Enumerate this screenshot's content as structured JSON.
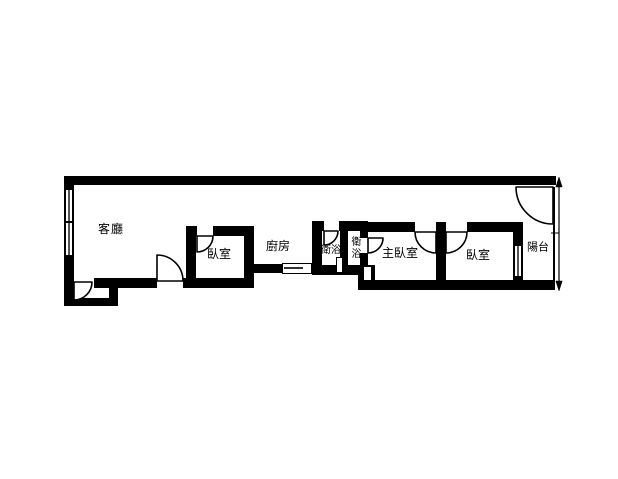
{
  "plan": {
    "type": "apartment-floor-plan",
    "background_color": "#ffffff",
    "wall_color": "#000000",
    "rooms": [
      {
        "id": "living-room",
        "label": "客廳"
      },
      {
        "id": "bedroom-1",
        "label": "臥室"
      },
      {
        "id": "kitchen",
        "label": "廚房"
      },
      {
        "id": "bathroom-1",
        "label": "衛浴"
      },
      {
        "id": "bathroom-2",
        "label": "衛浴"
      },
      {
        "id": "master-bedroom",
        "label": "主臥室"
      },
      {
        "id": "bedroom-2",
        "label": "臥室"
      },
      {
        "id": "balcony",
        "label": "陽台"
      }
    ]
  }
}
